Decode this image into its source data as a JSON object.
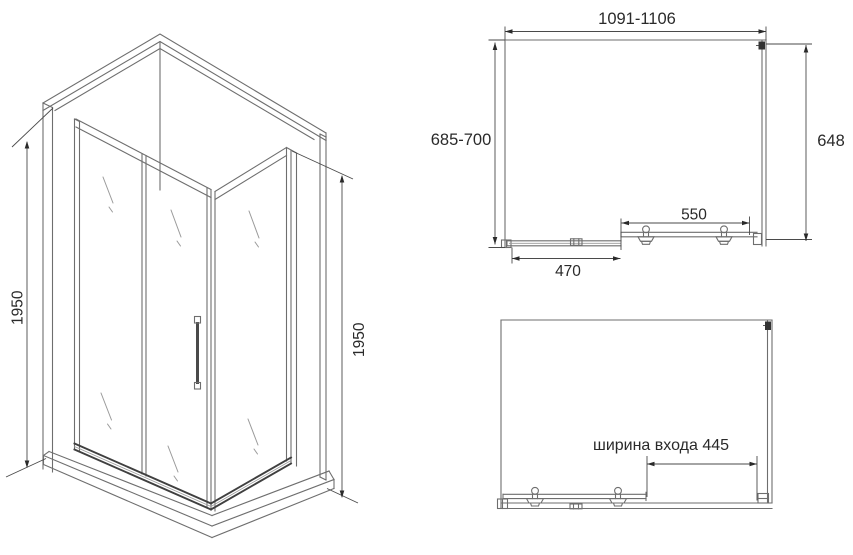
{
  "drawing_type": "shower enclosure technical drawing",
  "colors": {
    "background": "#ffffff",
    "line": "#6e6e6e",
    "line_dark": "#3f3f3f",
    "dimension_text": "#2a2a2a"
  },
  "iso_view": {
    "height_left_label": "1950",
    "height_right_label": "1950"
  },
  "top_view": {
    "width_label": "1091-1106",
    "depth_label": "685-700",
    "side_glass_label": "648",
    "door_label": "550",
    "fixed_panel_label": "470"
  },
  "entry_view": {
    "entry_width_label": "ширина входа 445"
  }
}
